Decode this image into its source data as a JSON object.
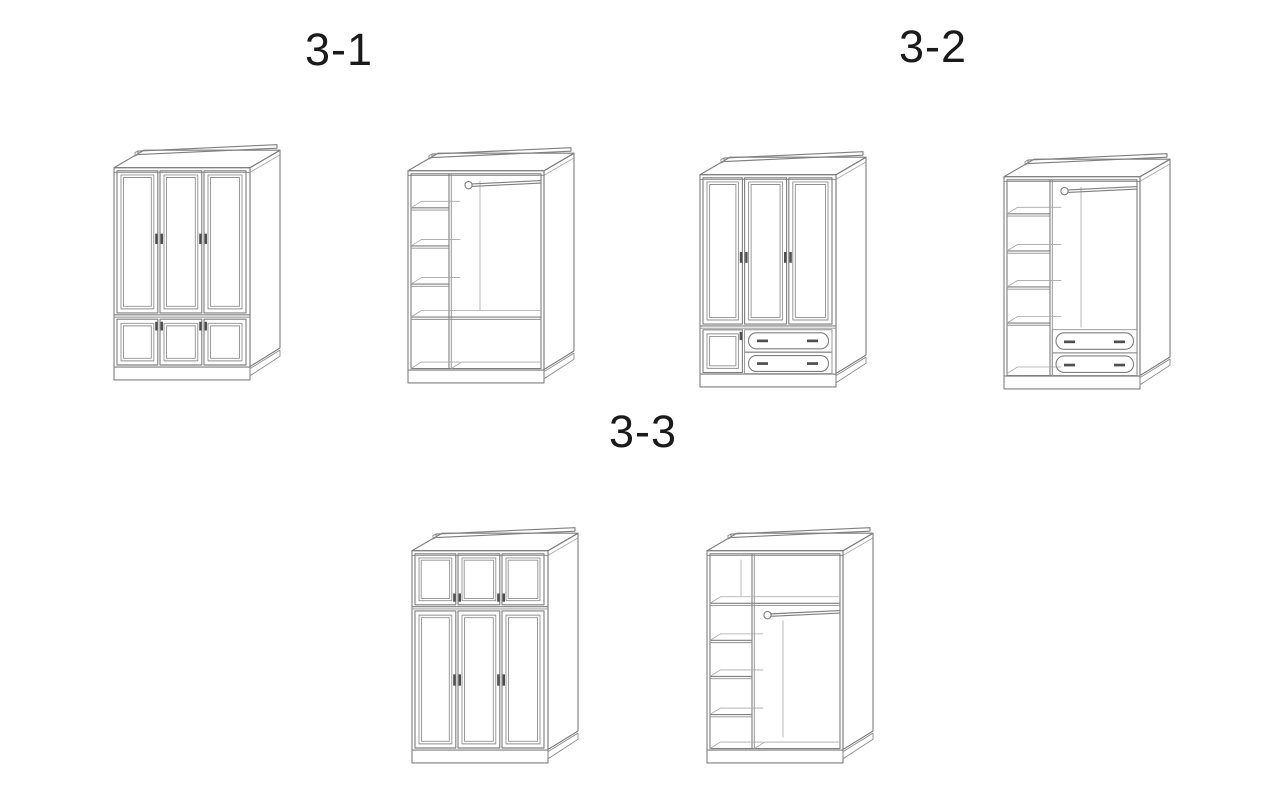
{
  "canvas": {
    "width": 1280,
    "height": 800,
    "background": "#ffffff"
  },
  "palette": {
    "line": "#7f7f7f",
    "line_detail": "#8f8f8f",
    "line_light": "#a8a8a8",
    "handle": "#4f4f4f",
    "label_text": "#1a1a1a"
  },
  "sections": [
    {
      "label": "3-1",
      "figures": [
        {
          "name": "wardrobe-3-1-closed"
        },
        {
          "name": "wardrobe-3-1-interior"
        }
      ]
    },
    {
      "label": "3-2",
      "figures": [
        {
          "name": "wardrobe-3-2-closed"
        },
        {
          "name": "wardrobe-3-2-interior"
        }
      ]
    },
    {
      "label": "3-3",
      "figures": [
        {
          "name": "wardrobe-3-3-closed"
        },
        {
          "name": "wardrobe-3-3-interior"
        }
      ]
    }
  ]
}
